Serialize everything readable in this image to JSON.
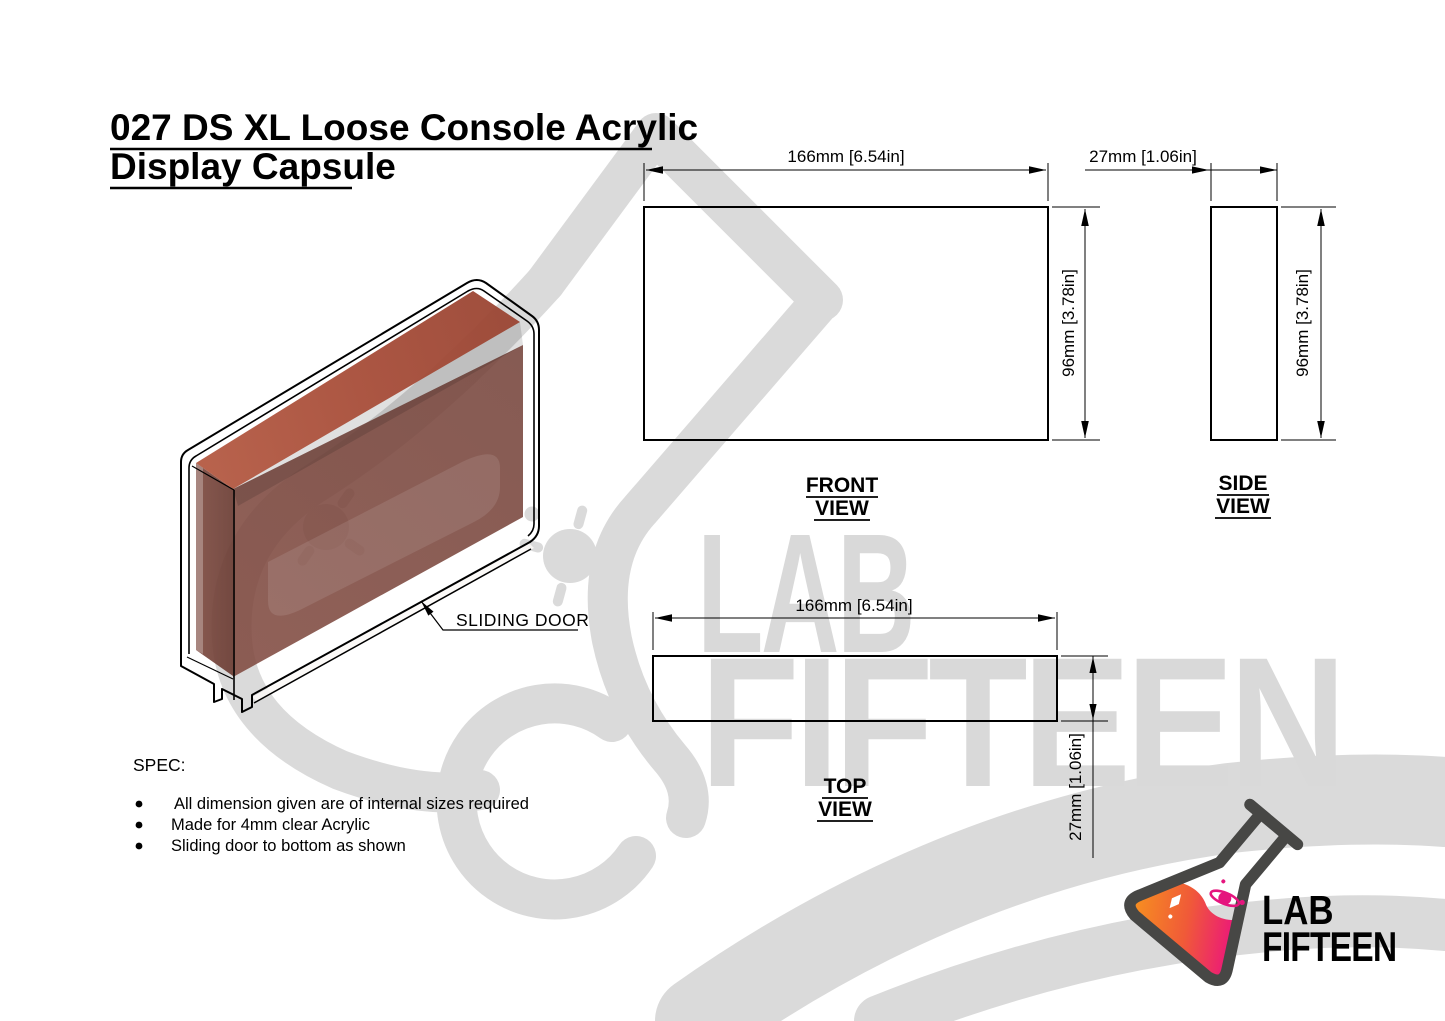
{
  "title": {
    "line1": "027 DS XL Loose Console Acrylic",
    "line2": "Display Capsule"
  },
  "iso_view": {
    "callout_label": "SLIDING DOOR"
  },
  "front_view": {
    "name_line1": "FRONT",
    "name_line2": "VIEW",
    "width_dim": "166mm [6.54in]",
    "height_dim": "96mm [3.78in]"
  },
  "side_view": {
    "name_line1": "SIDE",
    "name_line2": "VIEW",
    "width_dim": "27mm [1.06in]",
    "height_dim": "96mm [3.78in]"
  },
  "top_view": {
    "name_line1": "TOP",
    "name_line2": "VIEW",
    "width_dim": "166mm [6.54in]",
    "depth_dim": "27mm [1.06in]"
  },
  "spec": {
    "heading": "SPEC:",
    "items": [
      "All dimension given are of internal sizes required",
      "Made for 4mm clear Acrylic",
      "Sliding door to bottom as shown"
    ]
  },
  "watermark": {
    "word1": "LAB",
    "word2": "FIFTEEN"
  },
  "logo": {
    "word1": "LAB",
    "word2": "FIFTEEN"
  },
  "colors": {
    "line": "#000000",
    "watermark_gray": "#dadada",
    "console_top": "#a94e3a",
    "console_front": "#7b4a41",
    "console_cap": "#6a3c33",
    "logo_orange": "#f7941e",
    "logo_magenta": "#ec1a77",
    "logo_outline": "#474745",
    "logo_text_light": "#55555a",
    "logo_text_dark": "#3c3c40"
  }
}
